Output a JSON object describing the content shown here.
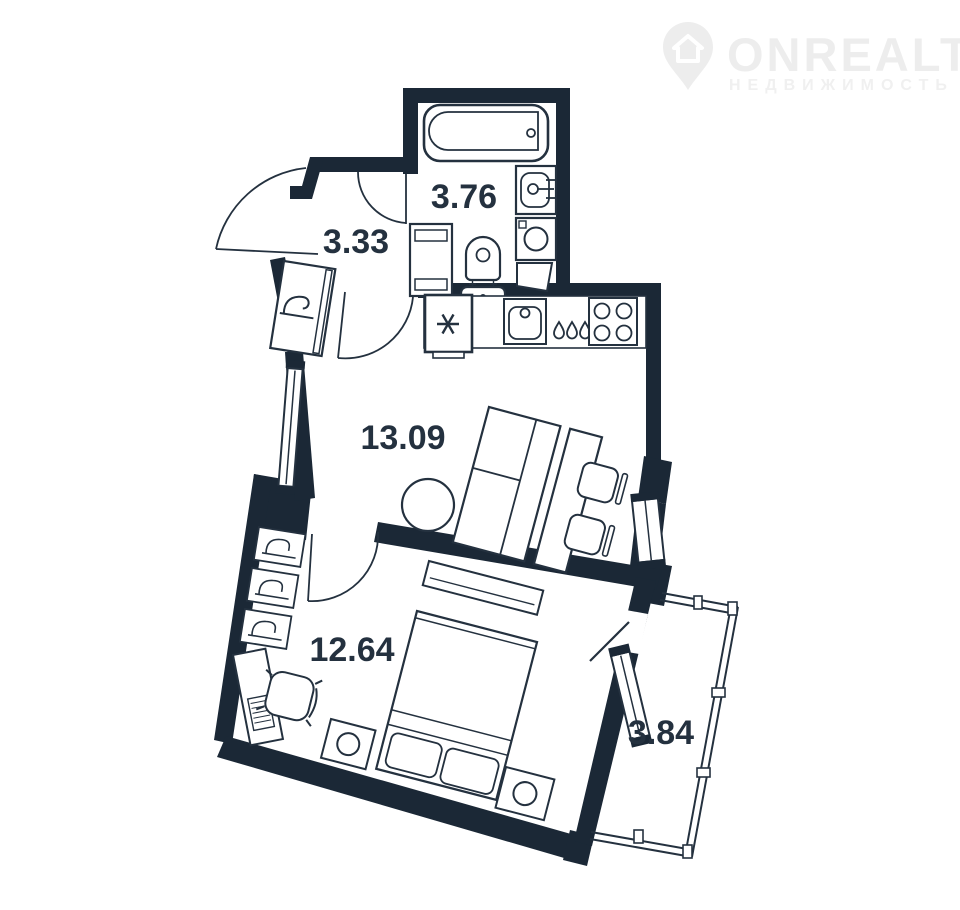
{
  "page": {
    "background": "#ffffff"
  },
  "watermark": {
    "brand": "ONREALT",
    "tagline": "НЕДВИЖИМОСТЬ",
    "icon": "location-pin-house",
    "color": "#ededed"
  },
  "floorplan": {
    "type": "apartment-floor-plan",
    "wall_color": "#1b2836",
    "line_color": "#24313f",
    "label_color": "#24313f",
    "rooms": [
      {
        "id": "bathroom",
        "label": "3.76"
      },
      {
        "id": "hallway",
        "label": "3.33"
      },
      {
        "id": "living-kitchen",
        "label": "13.09"
      },
      {
        "id": "bedroom",
        "label": "12.64"
      },
      {
        "id": "balcony",
        "label": "3.84"
      }
    ],
    "fixtures": [
      "bathtub",
      "washbasin",
      "washing-machine",
      "toilet",
      "water-heater",
      "shower-screen",
      "refrigerator-snowflake",
      "kitchen-sink",
      "water-drops",
      "hob-four-burners",
      "hall-wardrobe-hanger",
      "coat-hook-shelves",
      "sofa-bed",
      "round-table",
      "two-chairs",
      "double-bed",
      "nightstand-lamps",
      "desk-with-keyboard",
      "office-chair",
      "low-cabinet",
      "windows",
      "door-swings",
      "balcony-glazing"
    ]
  }
}
